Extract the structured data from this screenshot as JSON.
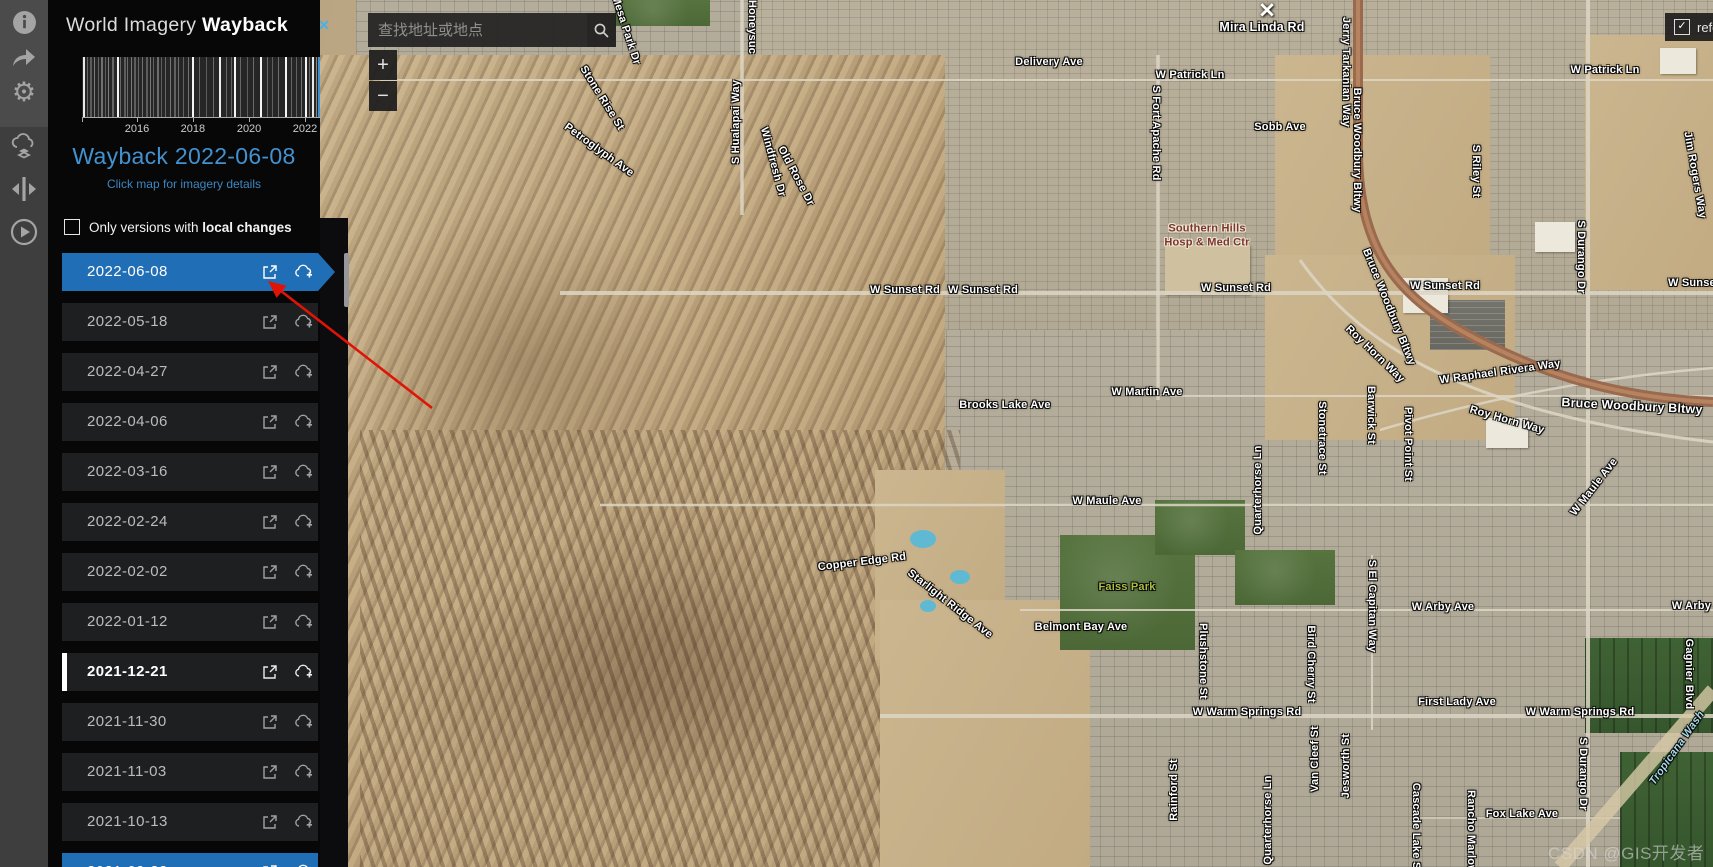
{
  "app": {
    "title_light": "World Imagery ",
    "title_bold": "Wayback"
  },
  "toolbar": {
    "icons": [
      "info-icon",
      "share-icon",
      "settings-gear-icon",
      "wayback-export-icon",
      "swipe-compare-icon",
      "animation-play-icon"
    ]
  },
  "sidebar": {
    "heading": "Wayback 2022-06-08",
    "subheading": "Click map for imagery details",
    "filter_prefix": "Only versions with ",
    "filter_bold": "local changes",
    "filter_checked": false
  },
  "timeline": {
    "type": "barcode",
    "title": "Wayback release timeline",
    "x_start": 2014.2,
    "x_end": 2022.5,
    "tick_labels": [
      "2016",
      "2018",
      "2020",
      "2022"
    ],
    "tick_pos": [
      0.231,
      0.466,
      0.702,
      0.937
    ],
    "selected_pos": 0.993,
    "selected_color": "#3f92d2",
    "lines": [
      [
        0.004,
        0.9,
        2
      ],
      [
        0.02,
        0.3,
        1
      ],
      [
        0.034,
        0.25,
        2
      ],
      [
        0.05,
        0.4,
        1
      ],
      [
        0.065,
        0.28,
        1
      ],
      [
        0.08,
        0.35,
        2
      ],
      [
        0.095,
        0.25,
        1
      ],
      [
        0.11,
        0.4,
        1
      ],
      [
        0.125,
        0.3,
        2
      ],
      [
        0.145,
        0.95,
        2
      ],
      [
        0.16,
        0.3,
        1
      ],
      [
        0.175,
        0.25,
        2
      ],
      [
        0.19,
        0.32,
        1
      ],
      [
        0.205,
        0.38,
        1
      ],
      [
        0.22,
        0.26,
        2
      ],
      [
        0.235,
        0.3,
        1
      ],
      [
        0.252,
        0.34,
        1
      ],
      [
        0.268,
        0.25,
        2
      ],
      [
        0.284,
        0.38,
        1
      ],
      [
        0.3,
        0.28,
        1
      ],
      [
        0.316,
        0.32,
        2
      ],
      [
        0.332,
        0.26,
        1
      ],
      [
        0.35,
        0.3,
        1
      ],
      [
        0.368,
        0.36,
        1
      ],
      [
        0.386,
        0.27,
        2
      ],
      [
        0.404,
        0.33,
        1
      ],
      [
        0.425,
        0.28,
        1
      ],
      [
        0.445,
        0.35,
        1
      ],
      [
        0.462,
        0.95,
        2
      ],
      [
        0.49,
        0.3,
        1
      ],
      [
        0.52,
        0.26,
        1
      ],
      [
        0.55,
        0.32,
        1
      ],
      [
        0.576,
        0.92,
        2
      ],
      [
        0.605,
        0.3,
        1
      ],
      [
        0.625,
        0.27,
        1
      ],
      [
        0.638,
        0.95,
        2
      ],
      [
        0.665,
        0.3,
        1
      ],
      [
        0.695,
        0.26,
        1
      ],
      [
        0.72,
        0.32,
        1
      ],
      [
        0.748,
        0.95,
        2
      ],
      [
        0.775,
        0.3,
        1
      ],
      [
        0.8,
        0.27,
        1
      ],
      [
        0.825,
        0.33,
        1
      ],
      [
        0.852,
        0.95,
        2
      ],
      [
        0.878,
        0.3,
        1
      ],
      [
        0.9,
        0.28,
        1
      ],
      [
        0.918,
        0.35,
        1
      ],
      [
        0.938,
        0.95,
        2
      ],
      [
        0.955,
        0.3,
        1
      ],
      [
        0.968,
        0.9,
        2
      ],
      [
        0.982,
        0.45,
        1
      ]
    ]
  },
  "versions": [
    {
      "date": "2022-06-08",
      "selected": true,
      "local_change": false,
      "partial": false
    },
    {
      "date": "2022-05-18",
      "selected": false,
      "local_change": false,
      "partial": false
    },
    {
      "date": "2022-04-27",
      "selected": false,
      "local_change": false,
      "partial": false
    },
    {
      "date": "2022-04-06",
      "selected": false,
      "local_change": false,
      "partial": false
    },
    {
      "date": "2022-03-16",
      "selected": false,
      "local_change": false,
      "partial": false
    },
    {
      "date": "2022-02-24",
      "selected": false,
      "local_change": false,
      "partial": false
    },
    {
      "date": "2022-02-02",
      "selected": false,
      "local_change": false,
      "partial": false
    },
    {
      "date": "2022-01-12",
      "selected": false,
      "local_change": false,
      "partial": false
    },
    {
      "date": "2021-12-21",
      "selected": false,
      "local_change": true,
      "partial": false
    },
    {
      "date": "2021-11-30",
      "selected": false,
      "local_change": false,
      "partial": false
    },
    {
      "date": "2021-11-03",
      "selected": false,
      "local_change": false,
      "partial": false
    },
    {
      "date": "2021-10-13",
      "selected": false,
      "local_change": false,
      "partial": false
    },
    {
      "date": "2021-09-22",
      "selected": true,
      "local_change": false,
      "partial": true
    }
  ],
  "search": {
    "placeholder": "查找地址或地点"
  },
  "map": {
    "zoom_in": "+",
    "zoom_out": "−",
    "reference_label": "refe",
    "reference_checked": true,
    "reference_check_glyph": "✓",
    "close_x": "✕",
    "marker_glyph": "✕",
    "watermark": "CSDN @GIS开发者",
    "labels": [
      {
        "t": "Honeysuc",
        "x": 752,
        "y": 27,
        "r": 90
      },
      {
        "t": "S Hualapai Way",
        "x": 736,
        "y": 122,
        "r": -90
      },
      {
        "t": "Mesa Park Dr",
        "x": 626,
        "y": 30,
        "r": 72
      },
      {
        "t": "Stone Rise St",
        "x": 602,
        "y": 98,
        "r": 58
      },
      {
        "t": "Petroglyph Ave",
        "x": 599,
        "y": 150,
        "r": 36
      },
      {
        "t": "Windfresh Dr",
        "x": 773,
        "y": 162,
        "r": 75
      },
      {
        "t": "Old Rose Dr",
        "x": 796,
        "y": 176,
        "r": 62
      },
      {
        "t": "Delivery Ave",
        "x": 1049,
        "y": 62,
        "r": 0
      },
      {
        "t": "W Patrick Ln",
        "x": 1190,
        "y": 75,
        "r": 0
      },
      {
        "t": "W Patrick Ln",
        "x": 1605,
        "y": 70,
        "r": 0
      },
      {
        "t": "Mira Linda Rd",
        "x": 1262,
        "y": 27,
        "r": 0,
        "c": "big"
      },
      {
        "t": "Sobb Ave",
        "x": 1280,
        "y": 127,
        "r": 0
      },
      {
        "t": "S Fort Apache Rd",
        "x": 1156,
        "y": 133,
        "r": 90
      },
      {
        "t": "Jerry Tarkanian Way",
        "x": 1346,
        "y": 72,
        "r": 90
      },
      {
        "t": "Bruce Woodbury Bltwy",
        "x": 1357,
        "y": 150,
        "r": 90
      },
      {
        "t": "S Riley St",
        "x": 1476,
        "y": 171,
        "r": 90
      },
      {
        "t": "Jim Rogers Way",
        "x": 1695,
        "y": 175,
        "r": 80
      },
      {
        "t": "Southern Hills\nHosp & Med Ctr",
        "x": 1207,
        "y": 236,
        "r": 0,
        "c": "poi"
      },
      {
        "t": "S Durango Dr",
        "x": 1581,
        "y": 257,
        "r": 90
      },
      {
        "t": "W Sunset Rd",
        "x": 905,
        "y": 290,
        "r": 0
      },
      {
        "t": "W Sunset Rd",
        "x": 983,
        "y": 290,
        "r": 0
      },
      {
        "t": "W Sunset Rd",
        "x": 1236,
        "y": 288,
        "r": 0
      },
      {
        "t": "W Sunset Rd",
        "x": 1445,
        "y": 286,
        "r": 0
      },
      {
        "t": "W Sunset Rd",
        "x": 1703,
        "y": 283,
        "r": 0
      },
      {
        "t": "Bruce Woodbury Bltwy",
        "x": 1389,
        "y": 307,
        "r": 68
      },
      {
        "t": "Roy Horn Way",
        "x": 1375,
        "y": 354,
        "r": 44
      },
      {
        "t": "W Raphael Rivera Way",
        "x": 1500,
        "y": 372,
        "r": -8
      },
      {
        "t": "Roy Horn Way",
        "x": 1507,
        "y": 420,
        "r": 16
      },
      {
        "t": "Bruce Woodbury Bltwy",
        "x": 1632,
        "y": 406,
        "r": 3,
        "c": "big"
      },
      {
        "t": "W Martin Ave",
        "x": 1147,
        "y": 392,
        "r": 0
      },
      {
        "t": "Brooks Lake Ave",
        "x": 1005,
        "y": 405,
        "r": 0
      },
      {
        "t": "Stonetrace St",
        "x": 1322,
        "y": 438,
        "r": 90
      },
      {
        "t": "Barwick St",
        "x": 1371,
        "y": 415,
        "r": 90
      },
      {
        "t": "Pivot Point St",
        "x": 1408,
        "y": 444,
        "r": 90
      },
      {
        "t": "W Maule Ave",
        "x": 1107,
        "y": 501,
        "r": 0
      },
      {
        "t": "W Maule Ave",
        "x": 1594,
        "y": 487,
        "r": -52
      },
      {
        "t": "Quarterhorse Ln",
        "x": 1258,
        "y": 490,
        "r": -90
      },
      {
        "t": "Copper Edge Rd",
        "x": 862,
        "y": 562,
        "r": -7
      },
      {
        "t": "Starlight Ridge Ave",
        "x": 950,
        "y": 604,
        "r": 38
      },
      {
        "t": "Faiss Park",
        "x": 1127,
        "y": 587,
        "r": 0,
        "c": "park"
      },
      {
        "t": "Belmont Bay Ave",
        "x": 1081,
        "y": 627,
        "r": 0
      },
      {
        "t": "S El Capitan Way",
        "x": 1372,
        "y": 606,
        "r": 90
      },
      {
        "t": "W Arby Ave",
        "x": 1443,
        "y": 607,
        "r": 0
      },
      {
        "t": "W Arby Ave",
        "x": 1703,
        "y": 606,
        "r": 0
      },
      {
        "t": "Gagnier Blvd",
        "x": 1689,
        "y": 674,
        "r": 90
      },
      {
        "t": "First Lady Ave",
        "x": 1457,
        "y": 702,
        "r": 0
      },
      {
        "t": "W Warm Springs Rd",
        "x": 1247,
        "y": 712,
        "r": 0
      },
      {
        "t": "W Warm Springs Rd",
        "x": 1580,
        "y": 712,
        "r": 0
      },
      {
        "t": "Plushstone St",
        "x": 1203,
        "y": 661,
        "r": 90
      },
      {
        "t": "Bird Cherry St",
        "x": 1311,
        "y": 664,
        "r": 90
      },
      {
        "t": "S Durango Dr",
        "x": 1583,
        "y": 774,
        "r": 90
      },
      {
        "t": "Tropicana Wash",
        "x": 1677,
        "y": 748,
        "r": -55,
        "c": "water"
      },
      {
        "t": "Rainford St",
        "x": 1174,
        "y": 790,
        "r": -90
      },
      {
        "t": "Van Cleef St",
        "x": 1315,
        "y": 759,
        "r": -90
      },
      {
        "t": "Jesworth St",
        "x": 1346,
        "y": 766,
        "r": -90
      },
      {
        "t": "Quarterhorse Ln",
        "x": 1268,
        "y": 820,
        "r": -90
      },
      {
        "t": "Cascade Lake St",
        "x": 1416,
        "y": 828,
        "r": 90
      },
      {
        "t": "Rancho Marlow",
        "x": 1471,
        "y": 832,
        "r": 90
      },
      {
        "t": "Fox Lake Ave",
        "x": 1522,
        "y": 814,
        "r": 0
      }
    ]
  },
  "colors": {
    "accent_blue": "#1f6eb6",
    "heading_blue": "#4392cf",
    "highway_brown": "#9b6a4e",
    "arrow_red": "#e01406",
    "toolbar_gray": "#4b4b4b"
  }
}
